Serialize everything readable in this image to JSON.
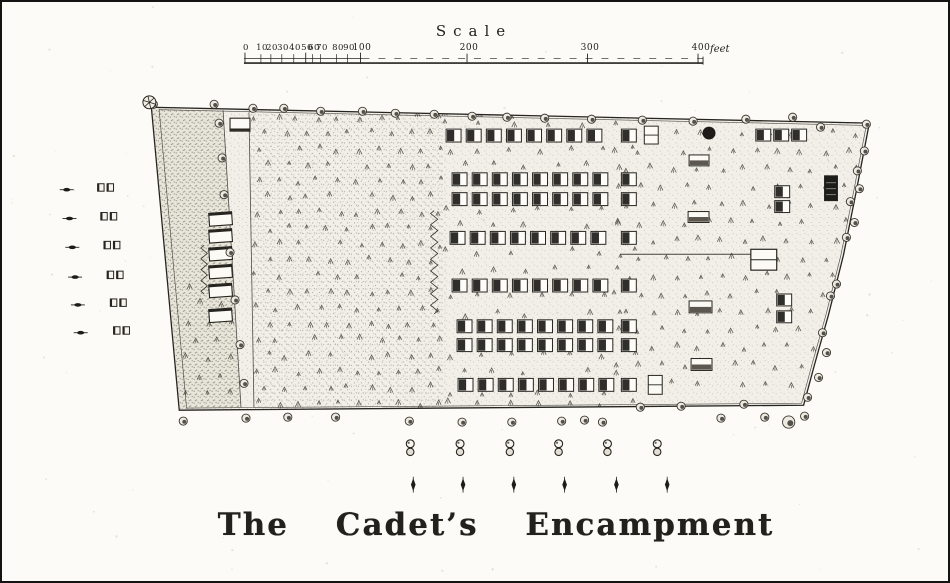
{
  "palette": {
    "paper": "#fcfbf7",
    "ink": "#26241f",
    "ink_light": "#45413a",
    "field_base": "#f1efe8",
    "strip_base": "#e8e5da",
    "stipple": "#6f6a5e",
    "dark_fill": "#1d1c18",
    "building_face": "#fbfaf5"
  },
  "scale_bar": {
    "title": "Scale",
    "unit": "feet",
    "y": 61,
    "x_start": 243,
    "x_end": 704,
    "solid_split_x": 362,
    "minor_ticks": [
      {
        "t": "0",
        "x": 244
      },
      {
        "t": "10",
        "x": 260
      },
      {
        "t": "20",
        "x": 270
      },
      {
        "t": "30",
        "x": 281
      },
      {
        "t": "40",
        "x": 293
      },
      {
        "t": "50",
        "x": 305
      },
      {
        "t": "60",
        "x": 312
      },
      {
        "t": "70",
        "x": 320
      },
      {
        "t": "80",
        "x": 336
      },
      {
        "t": "90",
        "x": 347
      },
      {
        "t": "100",
        "x": 360
      }
    ],
    "major_ticks": [
      {
        "t": "200",
        "x": 467
      },
      {
        "t": "300",
        "x": 588
      },
      {
        "t": "400",
        "x": 699
      }
    ]
  },
  "title": {
    "text": "The Cadet’s Encampment"
  },
  "map": {
    "boundary": [
      [
        150,
        106
      ],
      [
        871,
        122
      ],
      [
        858,
        190
      ],
      [
        845,
        255
      ],
      [
        830,
        315
      ],
      [
        816,
        365
      ],
      [
        805,
        406
      ],
      [
        178,
        411
      ]
    ],
    "strip": [
      [
        151,
        107
      ],
      [
        222,
        110
      ],
      [
        240,
        408
      ],
      [
        179,
        410
      ]
    ],
    "left_field": [
      [
        248,
        111
      ],
      [
        445,
        114
      ],
      [
        445,
        408
      ],
      [
        253,
        408
      ]
    ],
    "road": {
      "left": [
        [
          222,
          109
        ],
        [
          240,
          408
        ]
      ],
      "right": [
        [
          248,
          111
        ],
        [
          253,
          408
        ]
      ]
    },
    "tent_rows": {
      "tent_w": 15,
      "tent_h": 13,
      "pitch": 20.2,
      "count": 8,
      "detached_x": 622,
      "rows": [
        {
          "y": 128,
          "x0": 446
        },
        {
          "y": 172,
          "x0": 452
        },
        {
          "y": 192,
          "x0": 452
        },
        {
          "y": 231,
          "x0": 450
        },
        {
          "y": 279,
          "x0": 452
        },
        {
          "y": 320,
          "x0": 457
        },
        {
          "y": 339,
          "x0": 457
        },
        {
          "y": 379,
          "x0": 458
        }
      ]
    },
    "scattered_tents": [
      [
        757,
        128
      ],
      [
        775,
        128
      ],
      [
        793,
        128
      ],
      [
        776,
        185
      ],
      [
        776,
        200
      ],
      [
        778,
        294
      ],
      [
        778,
        311
      ]
    ],
    "split_rects": [
      [
        645,
        125,
        14,
        18
      ],
      [
        649,
        376,
        14,
        19
      ]
    ],
    "h_buildings": [
      [
        690,
        154,
        20,
        11
      ],
      [
        689,
        211,
        21,
        11
      ],
      [
        690,
        301,
        23,
        12
      ],
      [
        692,
        359,
        21,
        12
      ]
    ],
    "big_building": [
      752,
      249,
      26,
      21
    ],
    "dark_building": [
      826,
      175,
      13,
      25
    ],
    "road_buildings": {
      "x0": 208,
      "w": 23,
      "h": 13,
      "ys": [
        212,
        229,
        247,
        265,
        284,
        309
      ]
    },
    "top_building": [
      229,
      117,
      20,
      13
    ],
    "officers_line": [
      [
        621,
        254
      ],
      [
        752,
        254
      ]
    ],
    "dark_circle": [
      710,
      132,
      6.5
    ],
    "zigzags": [
      {
        "x": 434,
        "y0": 210,
        "y1": 314,
        "teeth": 18,
        "amp": 3.6
      },
      {
        "x": 203,
        "y0": 245,
        "y1": 294,
        "teeth": 9,
        "amp": 3.2
      }
    ],
    "trees": {
      "corner": [
        148,
        101
      ],
      "top": [
        [
          152,
          103
        ],
        [
          213,
          103
        ],
        [
          252,
          107
        ],
        [
          283,
          107
        ],
        [
          320,
          110
        ],
        [
          362,
          110
        ],
        [
          395,
          112
        ],
        [
          434,
          113
        ],
        [
          472,
          115
        ],
        [
          507,
          116
        ],
        [
          545,
          117
        ],
        [
          592,
          118
        ],
        [
          643,
          119
        ],
        [
          694,
          120
        ],
        [
          747,
          118
        ],
        [
          794,
          116
        ],
        [
          822,
          126
        ],
        [
          868,
          123
        ]
      ],
      "right": [
        [
          866,
          150
        ],
        [
          859,
          170
        ],
        [
          861,
          188
        ],
        [
          852,
          201
        ],
        [
          856,
          222
        ],
        [
          848,
          237
        ],
        [
          838,
          284
        ],
        [
          832,
          296
        ],
        [
          824,
          333
        ],
        [
          828,
          353
        ],
        [
          820,
          378
        ],
        [
          809,
          398
        ]
      ],
      "bottom": [
        [
          182,
          422
        ],
        [
          245,
          419
        ],
        [
          287,
          418
        ],
        [
          335,
          418
        ],
        [
          409,
          422
        ],
        [
          462,
          423
        ],
        [
          512,
          423
        ],
        [
          562,
          422
        ],
        [
          585,
          421
        ],
        [
          603,
          423
        ],
        [
          641,
          408
        ],
        [
          682,
          407
        ],
        [
          722,
          419
        ],
        [
          745,
          405
        ],
        [
          766,
          418
        ],
        [
          790,
          423,
          1.5
        ],
        [
          806,
          417
        ]
      ],
      "road": [
        [
          218,
          122
        ],
        [
          221,
          157
        ],
        [
          223,
          194
        ],
        [
          229,
          252
        ],
        [
          234,
          300
        ],
        [
          239,
          345
        ],
        [
          243,
          384
        ]
      ]
    },
    "mark_regions": [
      {
        "x0": 256,
        "x1": 442,
        "y0": 116,
        "y1": 404,
        "dx": 20.5,
        "dy": 16,
        "stagger": 1
      },
      {
        "x0": 618,
        "x1": 868,
        "y0": 114,
        "y1": 400,
        "dx": 23,
        "dy": 18,
        "stagger": 1
      },
      {
        "x0": 186,
        "x1": 238,
        "y0": 286,
        "y1": 402,
        "dx": 21,
        "dy": 18,
        "stagger": 1
      },
      {
        "x0": 448,
        "x1": 614,
        "y0": 114,
        "y1": 123,
        "dx": 33,
        "dy": 9,
        "stagger": 0
      },
      {
        "x0": 448,
        "x1": 634,
        "y0": 149,
        "y1": 166,
        "dx": 31,
        "dy": 16,
        "stagger": 1
      },
      {
        "x0": 448,
        "x1": 634,
        "y0": 209,
        "y1": 226,
        "dx": 31,
        "dy": 16,
        "stagger": 1
      },
      {
        "x0": 448,
        "x1": 634,
        "y0": 251,
        "y1": 272,
        "dx": 31,
        "dy": 18,
        "stagger": 1
      },
      {
        "x0": 448,
        "x1": 634,
        "y0": 297,
        "y1": 315,
        "dx": 31,
        "dy": 17,
        "stagger": 1
      },
      {
        "x0": 448,
        "x1": 634,
        "y0": 355,
        "y1": 373,
        "dx": 31,
        "dy": 17,
        "stagger": 1
      },
      {
        "x0": 448,
        "x1": 634,
        "y0": 395,
        "y1": 404,
        "dx": 31,
        "dy": 9,
        "stagger": 0
      }
    ]
  },
  "left_margin_symbols": {
    "rows": [
      188,
      217,
      246,
      276,
      304,
      332
    ],
    "arrow_x0": 65,
    "arrow_drift": 2.8,
    "squares_x0": 96,
    "squares_drift": 3.2
  },
  "bottom_symbols": {
    "pump_xs": [
      410,
      460,
      510,
      559,
      608,
      658
    ],
    "pump_y": 449,
    "flag_xs": [
      413,
      463,
      514,
      565,
      617,
      668
    ],
    "flag_y": 486
  }
}
